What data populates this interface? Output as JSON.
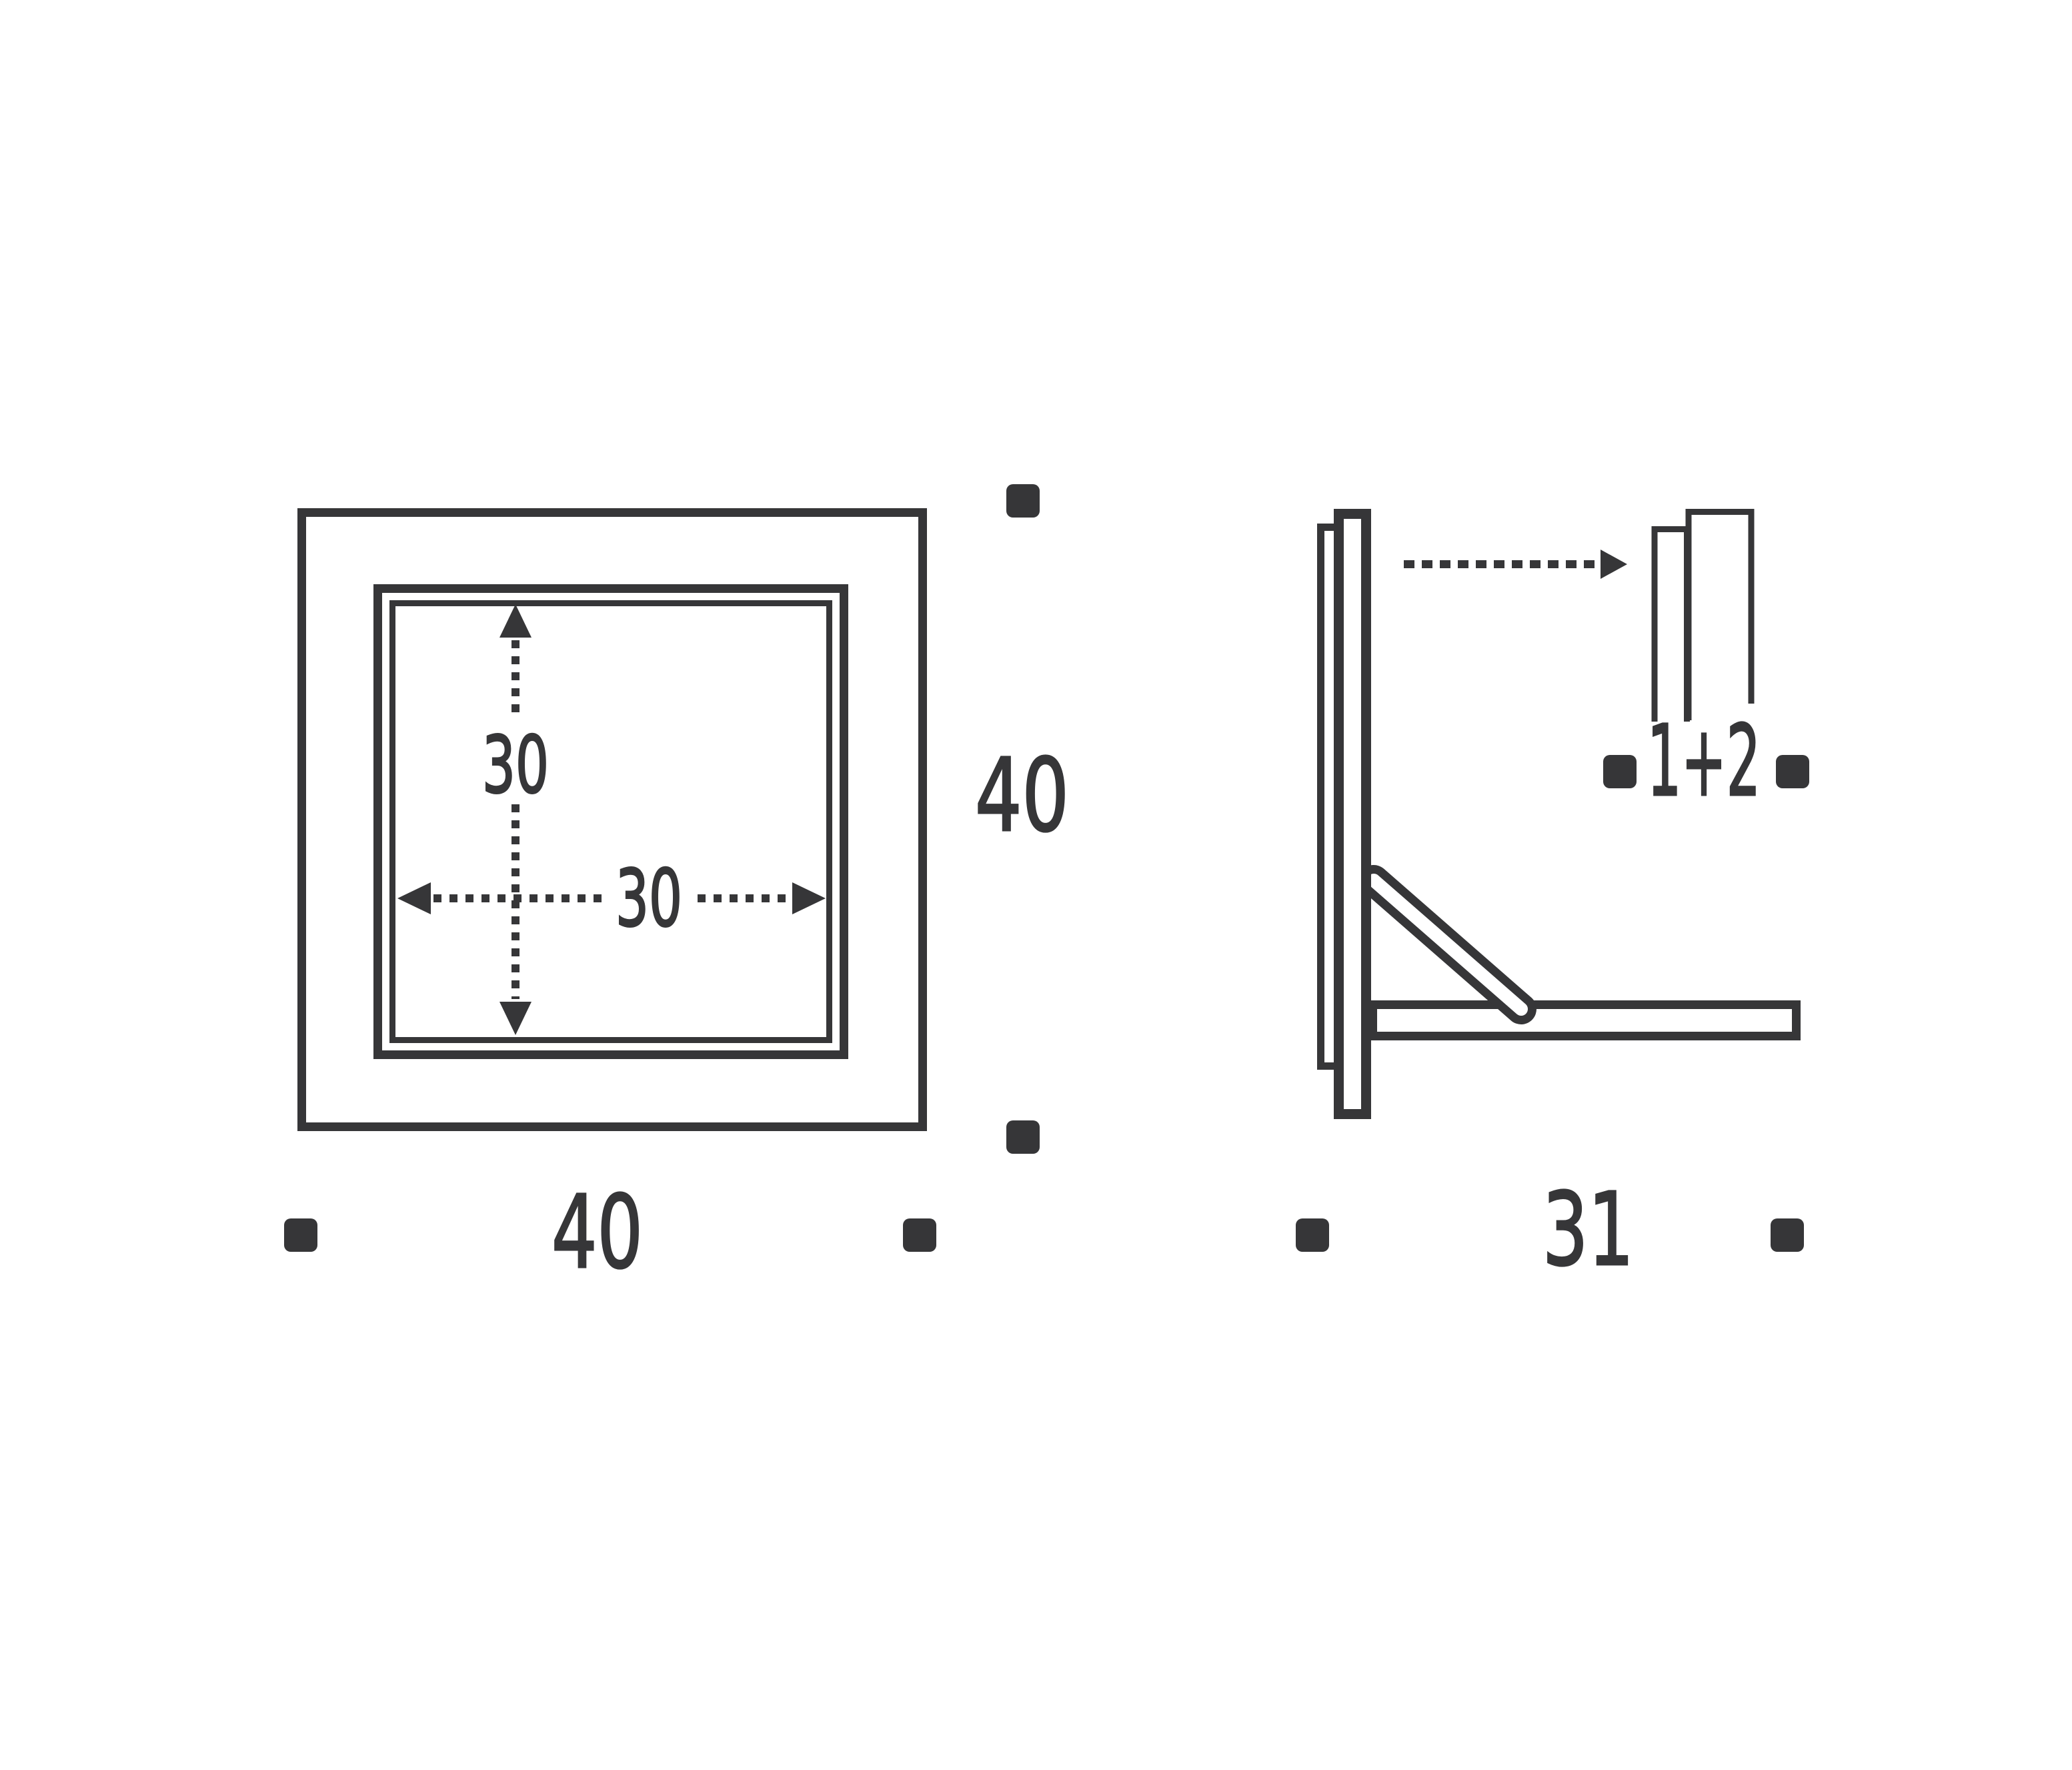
{
  "colors": {
    "ink": "#363638",
    "background": "#ffffff"
  },
  "drawing": {
    "front_view": {
      "outer_width": "40",
      "outer_height": "40",
      "inner_width": "30",
      "inner_height": "30"
    },
    "side_view": {
      "depth": "31",
      "panels": "1+2"
    },
    "marker_icon": "square-bullet"
  }
}
